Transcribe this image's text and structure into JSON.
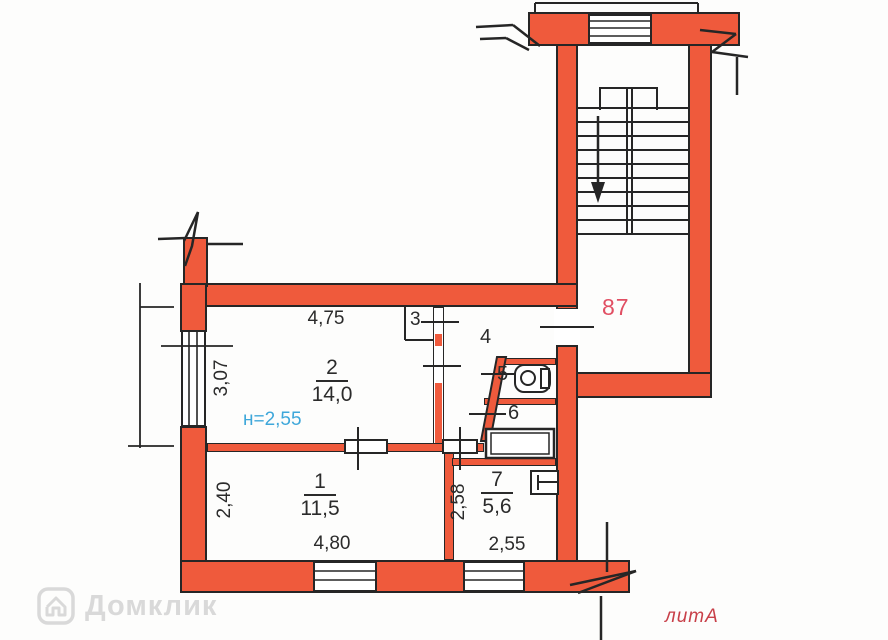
{
  "plan": {
    "apartment_number": "87",
    "litera": "литА",
    "ceiling_height": "н=2,55",
    "watermark": "Домклик",
    "rooms": {
      "room1": {
        "number": "1",
        "area": "11,5"
      },
      "room2": {
        "number": "2",
        "area": "14,0"
      },
      "room3": {
        "label": "3"
      },
      "room4": {
        "label": "4"
      },
      "room5": {
        "label": "5"
      },
      "room6": {
        "label": "6"
      },
      "room7": {
        "number": "7",
        "area": "5,6"
      }
    },
    "dimensions": {
      "room2_width": "4,75",
      "room2_depth": "3,07",
      "room1_width": "4,80",
      "room1_depth": "2,40",
      "room7_width": "2,55",
      "room7_depth": "2,58"
    },
    "colors": {
      "wall": "#ef5a3c",
      "height_text": "#3ea7da",
      "apartment_number_text": "#e14f63",
      "litera_text": "#c84049",
      "watermark_text": "#d3d3d3"
    }
  }
}
